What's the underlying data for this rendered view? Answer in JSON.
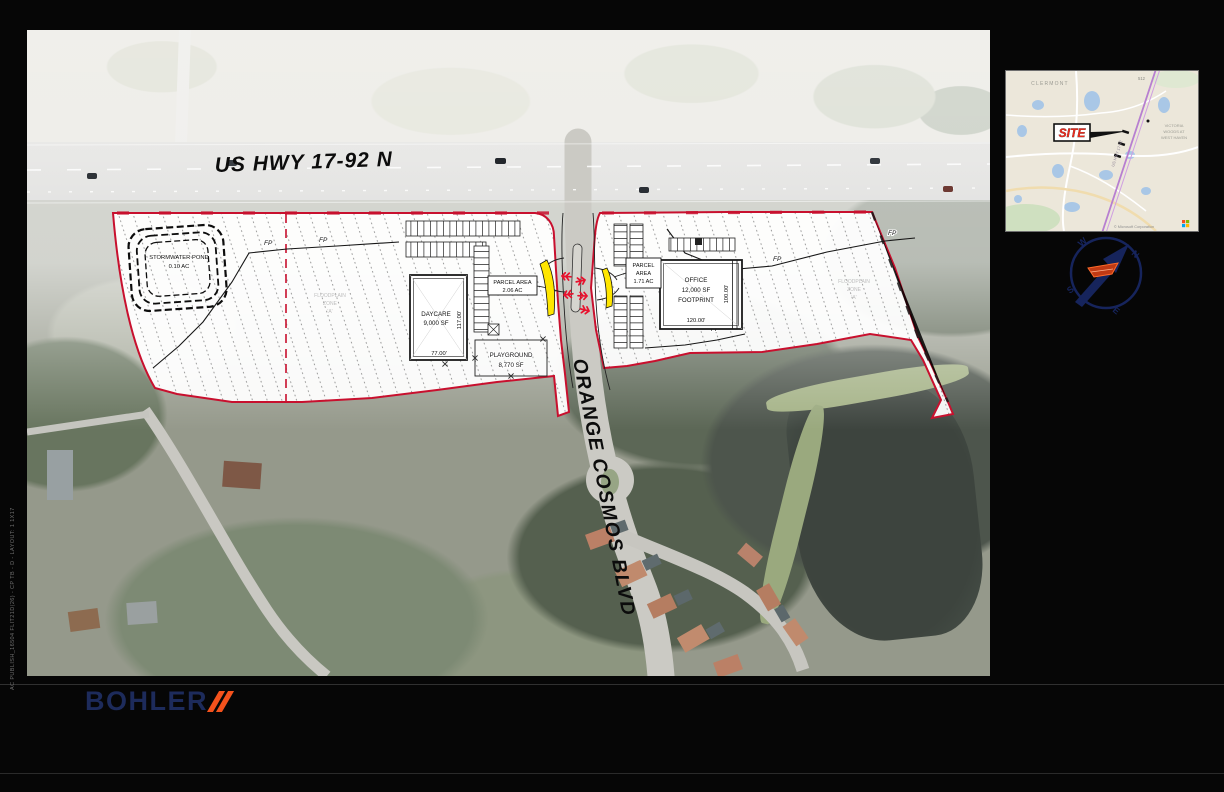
{
  "plan": {
    "highway_label": "US HWY 17-92 N",
    "street_label": "ORANGE COSMOS BLVD",
    "fp_marker": "FP",
    "stormwater_pond": {
      "line1": "STORMWATER POND",
      "line2": "0.10 AC"
    },
    "west_parcel": {
      "area_label": {
        "line1": "PARCEL AREA",
        "line2": "2.06 AC"
      },
      "building": {
        "line1": "DAYCARE",
        "line2": "9,000 SF",
        "width_dim": "77.00'",
        "depth_dim": "117.00'"
      },
      "playground": {
        "line1": "PLAYGROUND",
        "line2": "8,770 SF"
      },
      "floodplain": {
        "line1": "FLOODPLAIN",
        "line2": "ZONE",
        "line3": "'A'"
      }
    },
    "east_parcel": {
      "area_label": {
        "line1": "PARCEL",
        "line2": "AREA",
        "line3": "1.71 AC"
      },
      "building": {
        "line1": "OFFICE",
        "line2": "12,000 SF",
        "line3": "FOOTPRINT",
        "width_dim": "120.00'",
        "depth_dim": "100.00'"
      },
      "floodplain": {
        "line1": "FLOODPLAIN",
        "line2": "ZONE",
        "line3": "'A'"
      }
    },
    "colors": {
      "parcel_line": "#C8102E",
      "flare_yellow": "#FFE600",
      "arrow_red": "#E8112D"
    }
  },
  "inset": {
    "site_label": "SITE",
    "city_label": "CLERMONT",
    "neighborhood_label": {
      "line1": "VICTORIA",
      "line2": "WOODS AT",
      "line3": "WEST HAVEN"
    },
    "road_label": "US HWY 17-92",
    "corner_label": "512",
    "attribution": "© Microsoft Corporation"
  },
  "compass": {
    "n": "N",
    "e": "E",
    "s": "S",
    "w": "W"
  },
  "footer": {
    "brand": "BOHLER"
  },
  "edge_text": "AC PUBLISH_16504 FLIT21D(26) - CP TB - D - LAYOUT: 1 1X17"
}
